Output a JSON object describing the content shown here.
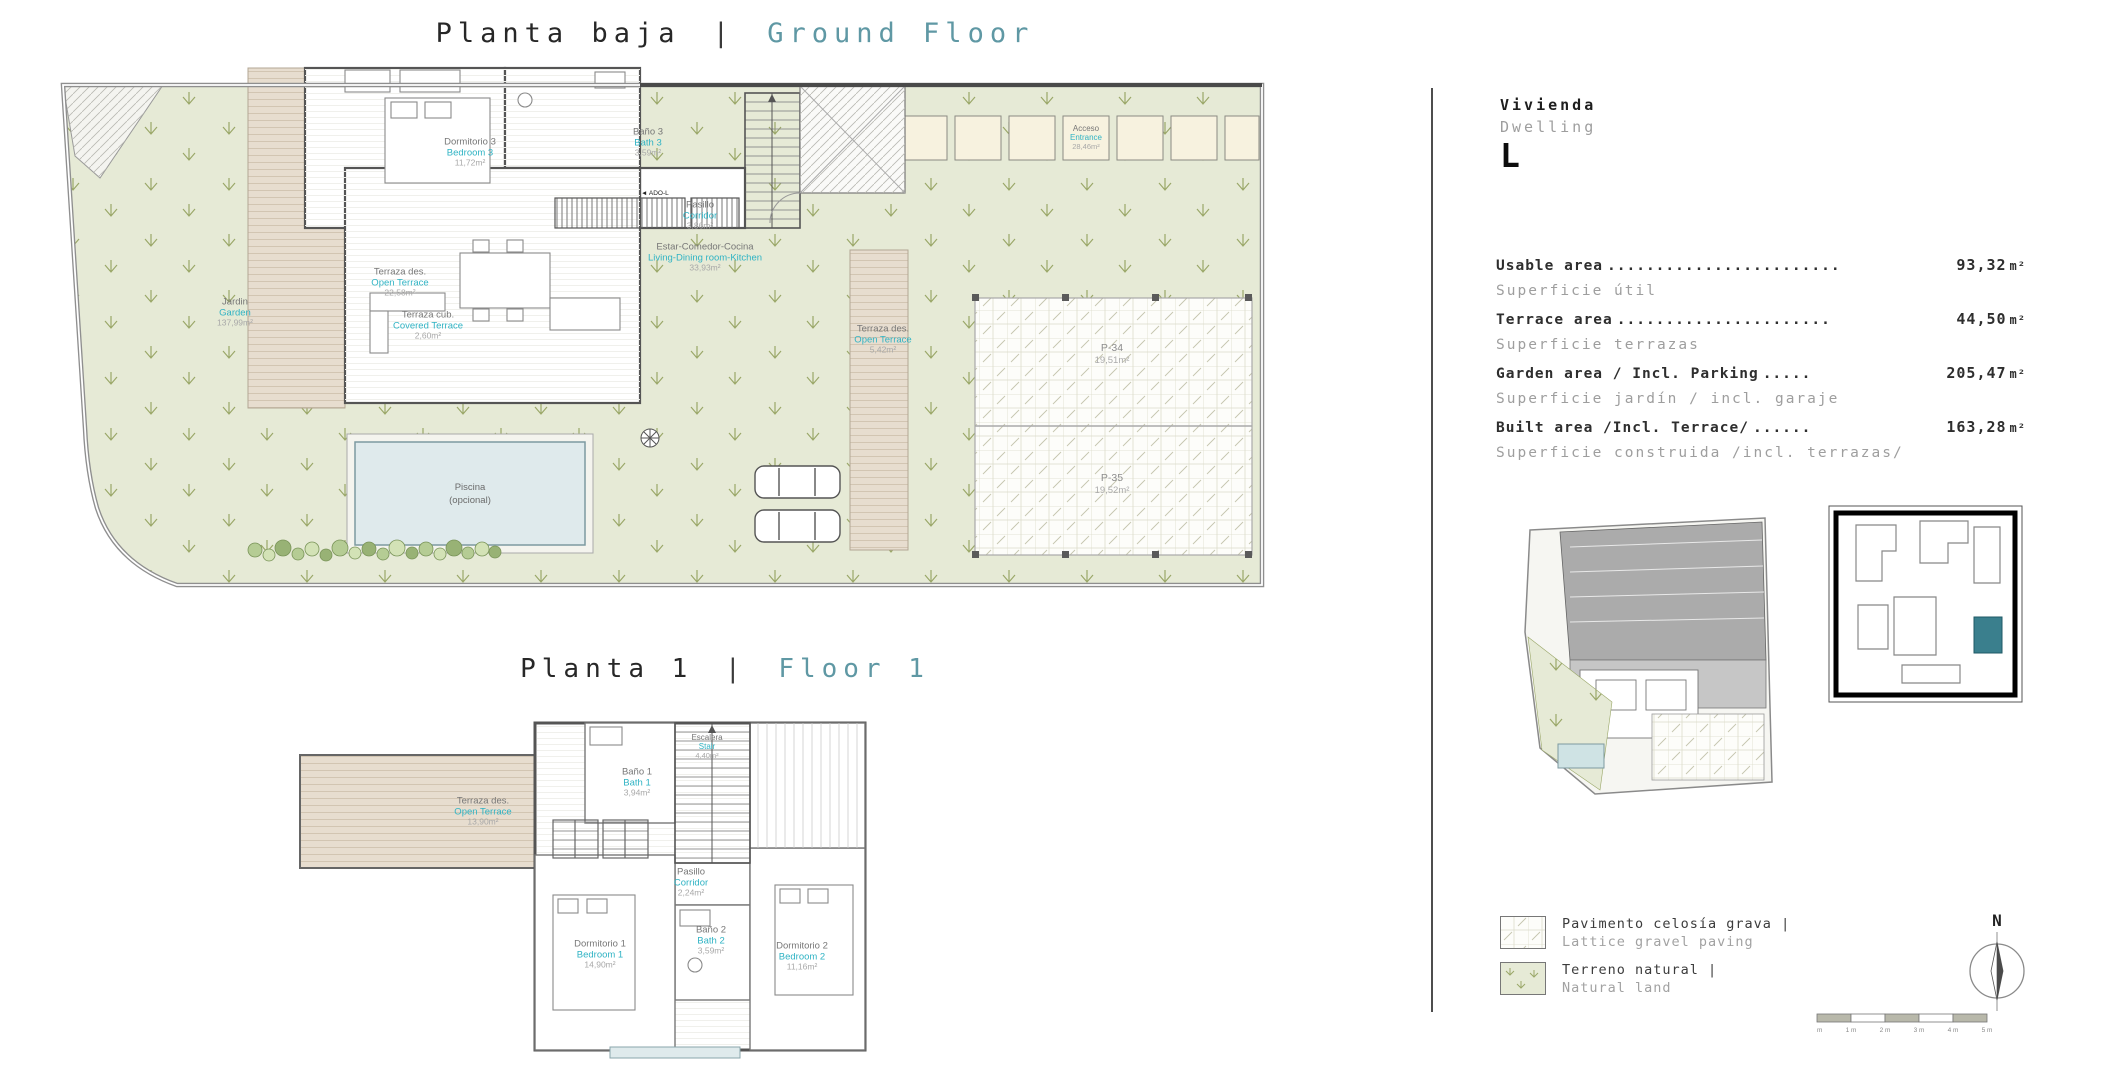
{
  "titles": {
    "ground": {
      "es": "Planta baja",
      "sep": "|",
      "en": "Ground Floor"
    },
    "floor1": {
      "es": "Planta 1",
      "sep": "|",
      "en": "Floor 1"
    }
  },
  "ground_floor": {
    "rooms": {
      "bedroom3": {
        "es": "Dormitorio 3",
        "en": "Bedroom 3",
        "area": "11,72m²"
      },
      "bath3": {
        "es": "Baño 3",
        "en": "Bath 3",
        "area": "3,59m²"
      },
      "corridor": {
        "es": "Pasillo",
        "en": "Corridor",
        "area": "3,86m²"
      },
      "living": {
        "es": "Estar-Comedor-Cocina",
        "en": "Living-Dining room-Kitchen",
        "area": "33,93m²"
      },
      "open_terrace_left": {
        "es": "Terraza des.",
        "en": "Open Terrace",
        "area": "22,58m²"
      },
      "covered_terrace": {
        "es": "Terraza cub.",
        "en": "Covered Terrace",
        "area": "2,60m²"
      },
      "garden": {
        "es": "Jardin",
        "en": "Garden",
        "area": "137,99m²"
      },
      "open_terrace_right": {
        "es": "Terraza des.",
        "en": "Open Terrace",
        "area": "5,42m²"
      },
      "entrance": {
        "es": "Acceso",
        "en": "Entrance",
        "area": "28,46m²"
      },
      "pool": {
        "line1": "Piscina",
        "line2": "(opcional)"
      },
      "parking1": {
        "name": "P-34",
        "area": "19,51m²"
      },
      "parking2": {
        "name": "P-35",
        "area": "19,52m²"
      },
      "ado": "◄ ADO-L"
    }
  },
  "floor1": {
    "rooms": {
      "bath1": {
        "es": "Baño 1",
        "en": "Bath 1",
        "area": "3,94m²"
      },
      "stair": {
        "es": "Escalera",
        "en": "Stair",
        "area": "4,40m²"
      },
      "corridor": {
        "es": "Pasillo",
        "en": "Corridor",
        "area": "2,24m²"
      },
      "bedroom1": {
        "es": "Dormitorio 1",
        "en": "Bedroom 1",
        "area": "14,90m²"
      },
      "bath2": {
        "es": "Baño 2",
        "en": "Bath 2",
        "area": "3,59m²"
      },
      "bedroom2": {
        "es": "Dormitorio 2",
        "en": "Bedroom 2",
        "area": "11,16m²"
      },
      "open_terrace": {
        "es": "Terraza des.",
        "en": "Open Terrace",
        "area": "13,90m²"
      }
    }
  },
  "panel": {
    "vivienda": "Vivienda",
    "dwelling": "Dwelling",
    "unit_letter": "L",
    "areas": [
      {
        "label": "Usable area",
        "dots": "........................",
        "value": "93,32",
        "unit": "m²",
        "sub": "Superficie útil"
      },
      {
        "label": "Terrace area",
        "dots": "......................",
        "value": "44,50",
        "unit": "m²",
        "sub": "Superficie terrazas"
      },
      {
        "label": "Garden area / Incl. Parking",
        "dots": " .....",
        "value": "205,47",
        "unit": "m²",
        "sub": "Superficie jardín / incl. garaje"
      },
      {
        "label": "Built area /Incl. Terrace/",
        "dots": " ......",
        "value": "163,28",
        "unit": "m²",
        "sub": "Superficie construida /incl. terrazas/"
      }
    ],
    "legend": [
      {
        "es": "Pavimento celosía grava |",
        "en": "Lattice gravel paving"
      },
      {
        "es": "Terreno natural |",
        "en": "Natural land"
      }
    ],
    "compass": "N",
    "scale_labels": [
      "0 m",
      "1 m",
      "2 m",
      "3 m",
      "4 m",
      "5 m"
    ]
  },
  "colors": {
    "teal_title": "#5f98a4",
    "cyan_label": "#2fb3c4",
    "garden_green": "#e6ead6",
    "deck_tan": "#e7ddcf",
    "pool_blue": "#dfeaec",
    "highlight_teal": "#3a7f8d"
  }
}
